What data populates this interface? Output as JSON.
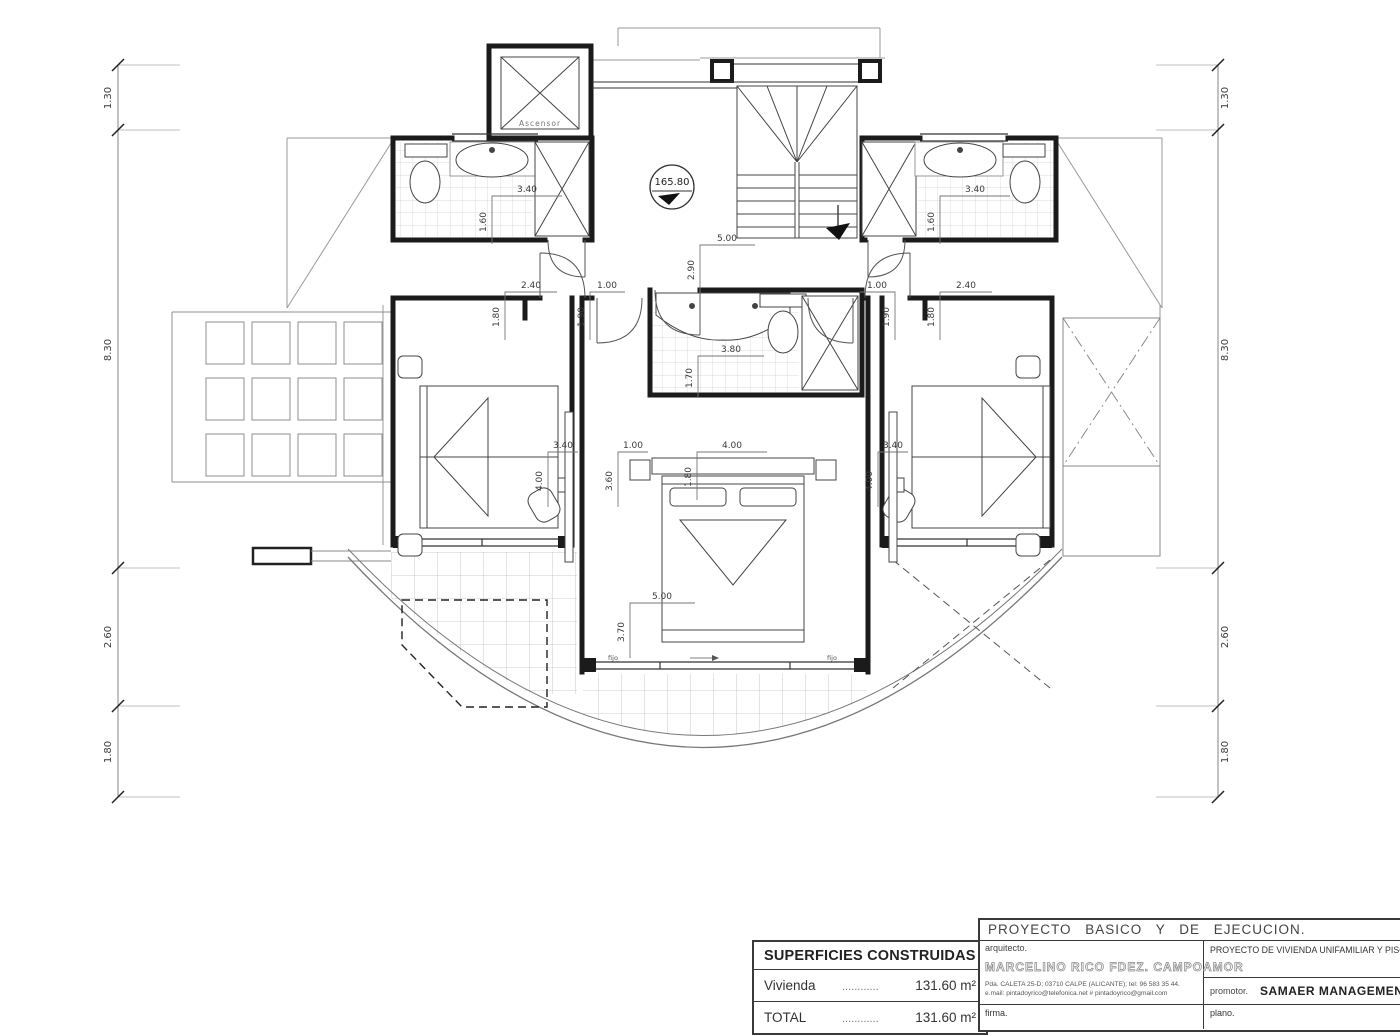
{
  "drawing": {
    "level_marker": "165.80",
    "elevator_label": "Ascensor",
    "window_labels": {
      "left": "fijo",
      "right": "fijo"
    },
    "chain_left": [
      "1.30",
      "8.30",
      "2.60",
      "1.80"
    ],
    "chain_right": [
      "1.30",
      "8.30",
      "2.60",
      "1.80"
    ],
    "dims": {
      "left_bath": {
        "h": "3.40",
        "v": "1.60"
      },
      "right_bath": {
        "h": "3.40",
        "v": "1.60"
      },
      "center_bath": {
        "h": "3.80",
        "v": "1.70"
      },
      "hall": {
        "h": "5.00",
        "v": "2.90"
      },
      "left_closet": {
        "h": "2.40",
        "v": "1.80"
      },
      "left_door": {
        "h": "1.00",
        "v": "1.90"
      },
      "right_door": {
        "h": "1.00",
        "v": "1.90"
      },
      "right_closet": {
        "h": "2.40",
        "v": "1.80"
      },
      "left_bed": {
        "h": "3.40",
        "v": "4.00"
      },
      "right_bed": {
        "h": "3.40",
        "v": "4.00"
      },
      "master_top_left": {
        "h": "1.00",
        "v": "3.60"
      },
      "master_top": {
        "h": "4.00",
        "v": "1.80"
      },
      "master_bottom": {
        "h": "5.00",
        "v": "3.70"
      }
    }
  },
  "surfaces_table": {
    "title": "SUPERFICIES CONSTRUIDAS",
    "rows": [
      {
        "label": "Vivienda",
        "dots": "............",
        "value": "131.60 m²"
      },
      {
        "label": "TOTAL",
        "dots": "............",
        "value": "131.60 m²"
      }
    ]
  },
  "title_block": {
    "project_title": "PROYECTO BASICO Y DE EJECUCION.",
    "architect_label": "arquitecto.",
    "architect_name": "MARCELINO RICO FDEZ. CAMPOAMOR",
    "architect_address": "Pda. CALETA 25-D; 03710 CALPE (ALICANTE); tel: 96 583 35 44.",
    "architect_email": "e.mail: pintadoyrico@telefonica.net    #    pintadoyrico@gmail.com",
    "project_description": "PROYECTO DE VIVIENDA UNIFAMILIAR Y PISCIN",
    "promoter_label": "promotor.",
    "promoter_name": "SAMAER MANAGEMENT S.L",
    "signature_label": "firma.",
    "plan_label": "plano."
  }
}
